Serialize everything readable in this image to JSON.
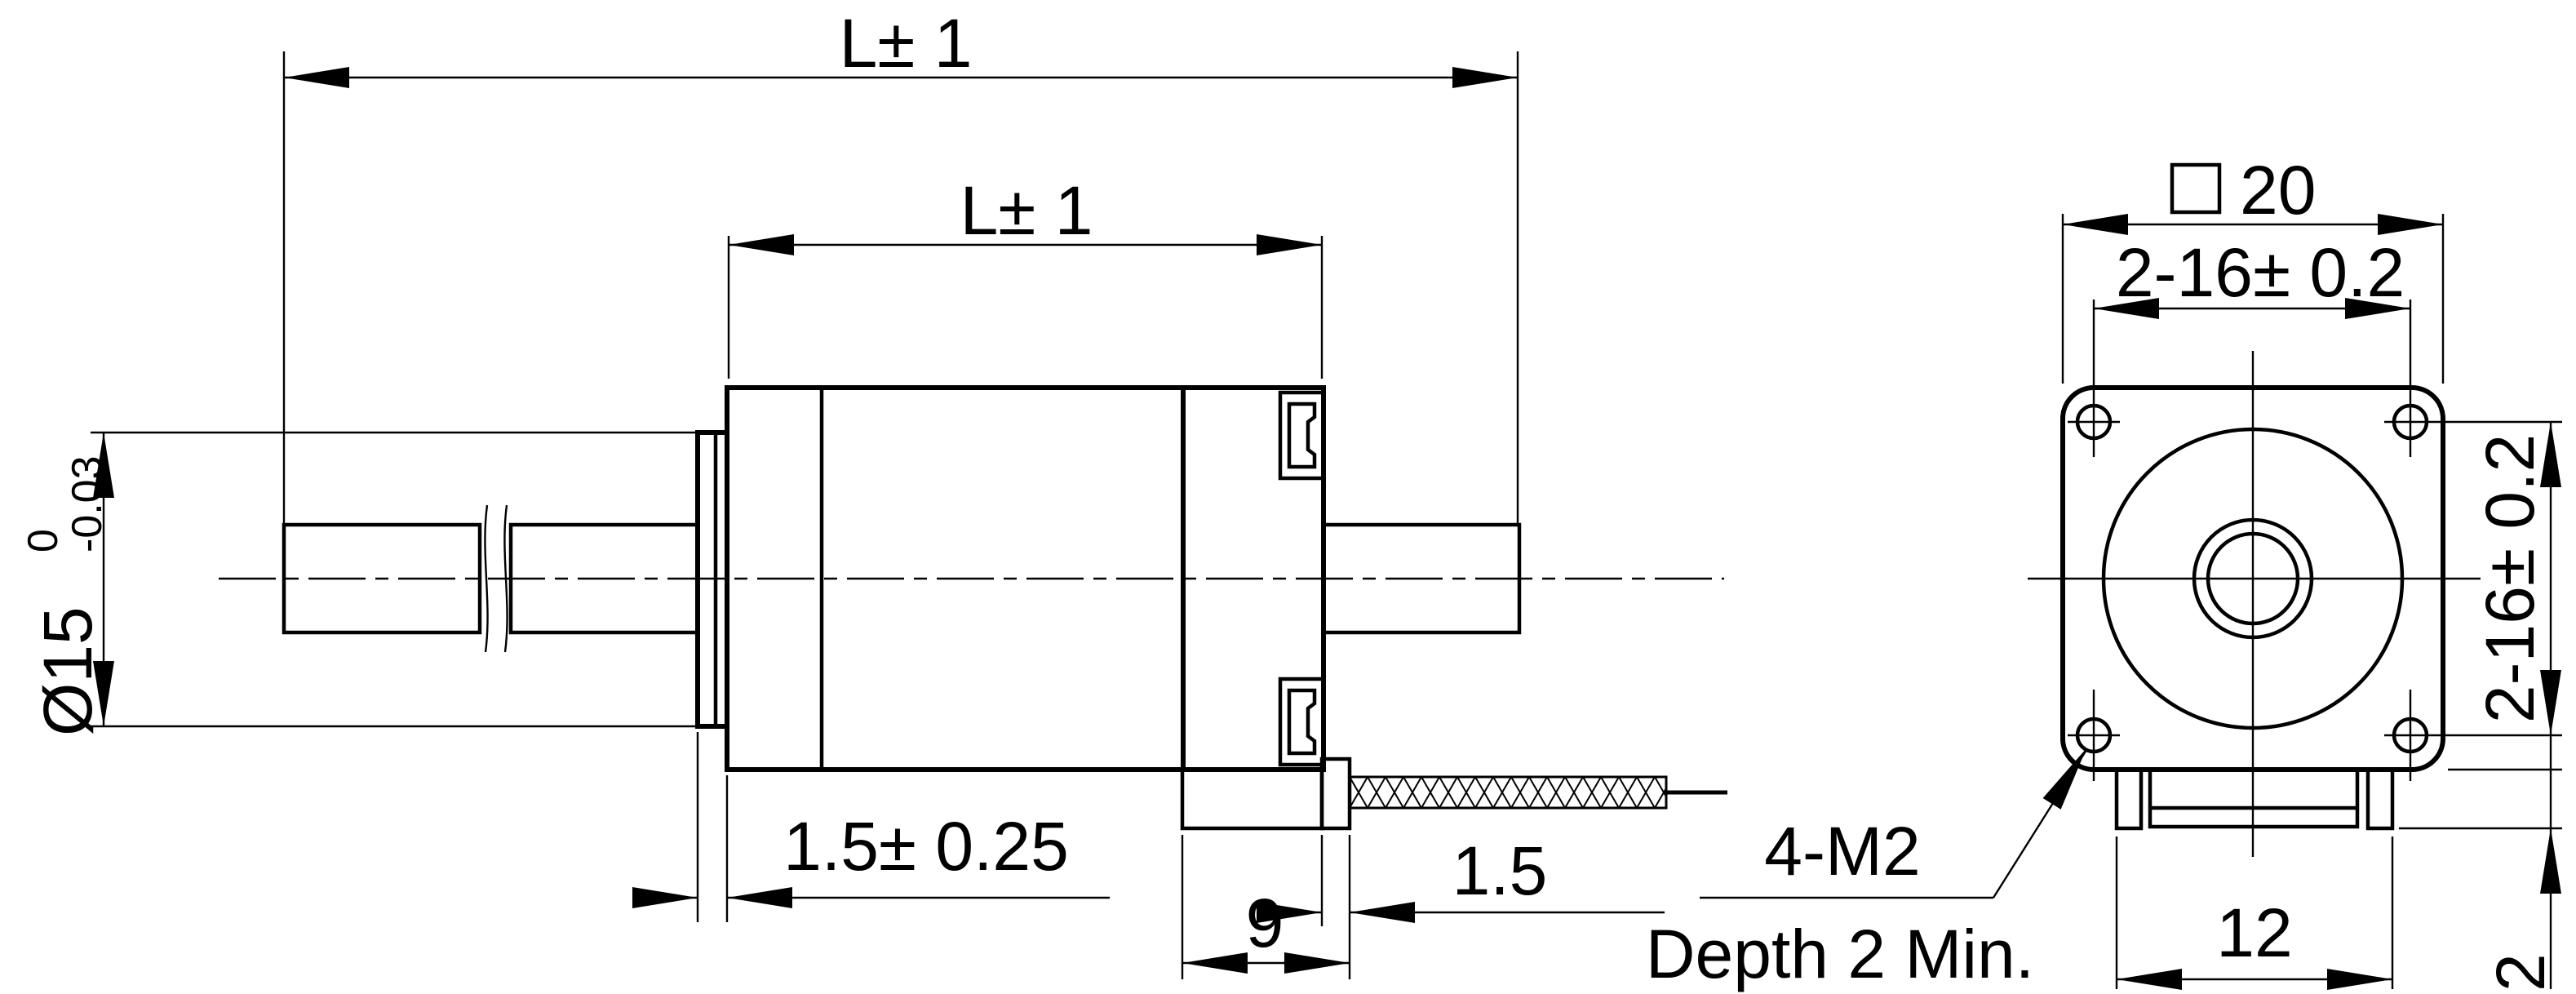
{
  "drawing": {
    "background_color": "#ffffff",
    "line_color": "#000000",
    "side_view": {
      "overall_length_label": "L± 1",
      "body_length_label": "L± 1",
      "screw_diameter_label": "Ø15",
      "screw_diameter_tol_upper": "0",
      "screw_diameter_tol_lower": "-0.03",
      "boss_thickness_label": "1.5± 0.25",
      "rear_housing_length_label": "9",
      "connector_protrusion_label": "1.5"
    },
    "front_view": {
      "face_width_symbol": "□",
      "face_width_label": "20",
      "hole_spacing_horizontal_label": "2-16± 0.2",
      "hole_spacing_vertical_label": "2-16± 0.2",
      "connector_width_label": "12",
      "connector_height_label": "2",
      "hole_callout_line1": "4-M2",
      "hole_callout_line2": "Depth 2 Min."
    }
  }
}
